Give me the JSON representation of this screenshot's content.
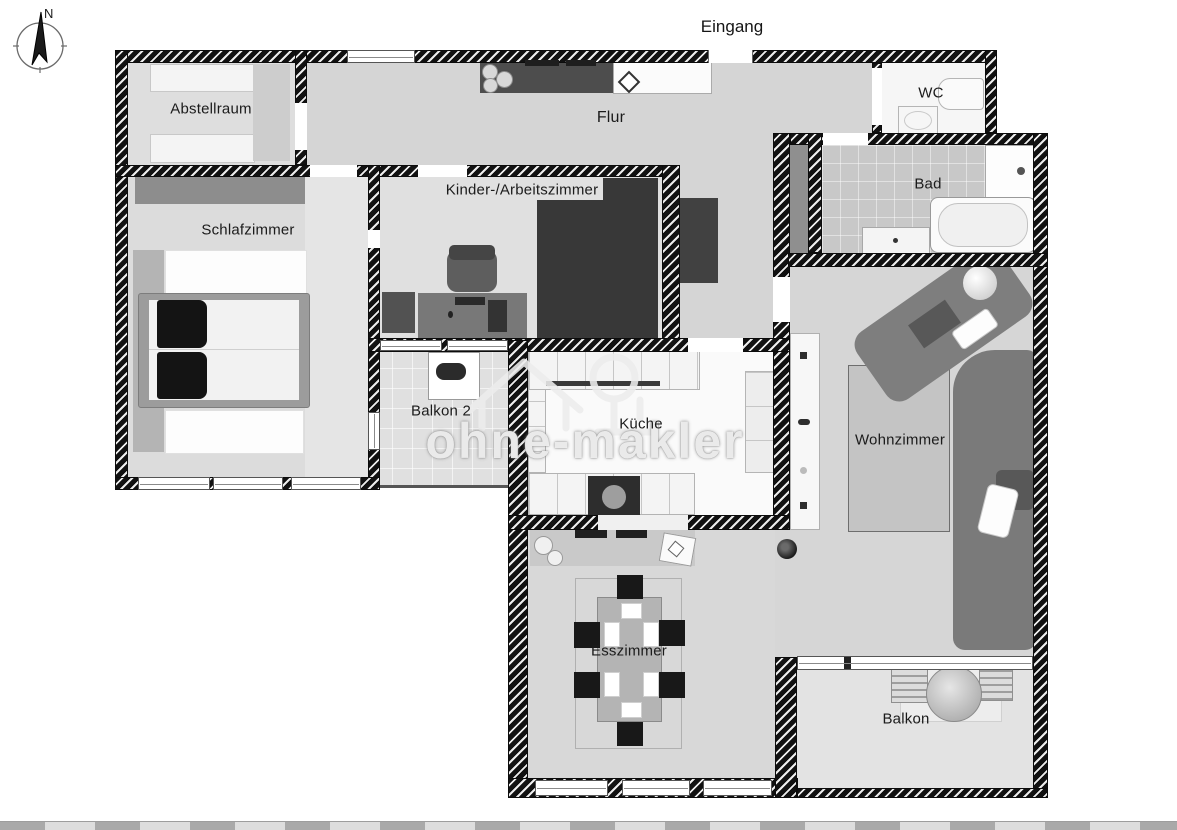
{
  "plan": {
    "entrance_label": "Eingang",
    "compass_north": "N",
    "rooms": [
      {
        "id": "abstellraum",
        "label": "Abstellraum"
      },
      {
        "id": "flur",
        "label": "Flur"
      },
      {
        "id": "wc",
        "label": "WC"
      },
      {
        "id": "bad",
        "label": "Bad"
      },
      {
        "id": "schlafzimmer",
        "label": "Schlafzimmer"
      },
      {
        "id": "kinder-arbeitszimmer",
        "label": "Kinder-/Arbeitszimmer"
      },
      {
        "id": "balkon-2",
        "label": "Balkon 2"
      },
      {
        "id": "kueche",
        "label": "Küche"
      },
      {
        "id": "wohnzimmer",
        "label": "Wohnzimmer"
      },
      {
        "id": "esszimmer",
        "label": "Esszimmer"
      },
      {
        "id": "balkon",
        "label": "Balkon"
      }
    ],
    "watermark": {
      "text": "ohne-makler"
    },
    "colors": {
      "wall": "#141414",
      "floor": "#d5d5d5",
      "floor_light": "#f6f6f6",
      "bath_tiles": "#c8c8c8",
      "furniture_dark": "#3a3a3a",
      "furniture_gray": "#8d8d8d",
      "sofa": "#7e7e7e"
    }
  }
}
